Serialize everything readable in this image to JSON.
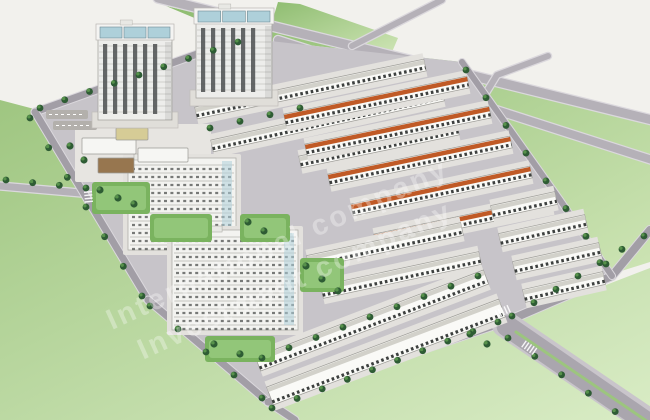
{
  "description": "Aerial 3D architectural rendering of a residential masterplan: two high-rise towers, mid-rise apartment blocks, rows of townhouses (some with orange roofs), tree-lined roads, boulevard with green median, surrounded by light-green fields, with a diagonal white watermark.",
  "watermark": {
    "lines": [
      "International company",
      "Investment company"
    ],
    "color": "#ffffff",
    "opacity": 0.32,
    "font_size": 29,
    "letter_spacing": 3,
    "angle_deg": -24.5,
    "origin": [
      112,
      330
    ],
    "line2_offset": [
      16,
      40
    ]
  },
  "scene": {
    "w": 650,
    "h": 420,
    "colors": {
      "bg": "#f2f1ed",
      "fieldDark": "#8fbd71",
      "fieldLight": "#cde4b4",
      "fieldDark2": "#9fc681",
      "fieldLight2": "#d9ecc5",
      "roadFill": "#b5b1b8",
      "roadCase": "#dbd8dd",
      "roadDark": "#a29ea6",
      "parcel": "#c7c4c9",
      "pad": "#e3e1dd",
      "rowWhite": "#fafaf7",
      "rowRoofWhite": "#d2d1ca",
      "rowWindow": "#3d403f",
      "rowOutline": "#9c9b96",
      "roofOrange": "#c05a26",
      "towerBody": "#ededeb",
      "towerStripe": "#4b4e50",
      "towerGlass": "#aed0da",
      "towerTrim": "#b9b7b2",
      "towerBase": "#e0ded9",
      "midBody": "#f3f3f0",
      "midLine": "#a8a8a2",
      "green1": "#7ab35f",
      "green2": "#98cb7f",
      "treeDark": "#2e5c34",
      "treeLight": "#57924b",
      "clubRoof": "#97764f",
      "court": "#d6cc96",
      "median": "#9cc57e",
      "white": "#ffffff"
    },
    "fields": [
      {
        "name": "field-left-bottom",
        "grad": "gLB",
        "pts": "0,100 38,110 152,302 484,332 650,268 650,420 0,420"
      },
      {
        "name": "field-top-right",
        "grad": "gTR",
        "pts": "166,6 650,118 650,262 612,274 462,62 242,38"
      },
      {
        "name": "field-top-wedge",
        "grad": "gTR",
        "pts": "272,22 392,52 398,38 300,4 278,2"
      }
    ],
    "roads": [
      {
        "name": "arterial-1",
        "w": 9,
        "pts": [
          [
            158,
            -2
          ],
          [
            652,
            120
          ]
        ]
      },
      {
        "name": "arterial-2",
        "w": 8,
        "pts": [
          [
            278,
            40
          ],
          [
            652,
            160
          ]
        ]
      },
      {
        "name": "road-stub-1",
        "w": 6,
        "pts": [
          [
            352,
            46
          ],
          [
            442,
            0
          ]
        ]
      },
      {
        "name": "road-stub-2",
        "w": 6,
        "pts": [
          [
            478,
            106
          ],
          [
            497,
            75
          ],
          [
            548,
            56
          ]
        ]
      },
      {
        "name": "road-stub-left",
        "w": 7,
        "pts": [
          [
            0,
            186
          ],
          [
            92,
            194
          ]
        ]
      }
    ],
    "parcel": "35,112 242,38 462,62 612,276 505,322 268,402 148,300",
    "perimRoads": [
      {
        "name": "perimeter-nw",
        "w": 7,
        "pts": [
          [
            35,
            112
          ],
          [
            242,
            38
          ]
        ]
      },
      {
        "name": "perimeter-west",
        "w": 7,
        "pts": [
          [
            35,
            112
          ],
          [
            148,
            300
          ]
        ]
      },
      {
        "name": "perimeter-sw",
        "w": 7,
        "pts": [
          [
            148,
            300
          ],
          [
            268,
            402
          ]
        ]
      },
      {
        "name": "perimeter-exit-bottom",
        "w": 7,
        "pts": [
          [
            268,
            402
          ],
          [
            295,
            420
          ]
        ]
      },
      {
        "name": "perimeter-south",
        "w": 7,
        "pts": [
          [
            268,
            402
          ],
          [
            505,
            322
          ]
        ]
      },
      {
        "name": "perimeter-se",
        "w": 8,
        "pts": [
          [
            505,
            322
          ],
          [
            612,
            276
          ],
          [
            650,
            230
          ]
        ]
      },
      {
        "name": "perimeter-ne",
        "w": 6,
        "pts": [
          [
            462,
            62
          ],
          [
            560,
            200
          ],
          [
            612,
            276
          ]
        ]
      }
    ],
    "boulevard": {
      "case": {
        "w": 27,
        "pts": [
          [
            505,
            324
          ],
          [
            658,
            428
          ]
        ]
      },
      "lanes": {
        "w": 21,
        "pts": [
          [
            507,
            326
          ],
          [
            658,
            430
          ]
        ]
      },
      "median": {
        "w": 3,
        "pts": [
          [
            516,
            332
          ],
          [
            654,
            426
          ]
        ]
      }
    },
    "zones": [
      {
        "name": "school-grounds",
        "x": 75,
        "y": 124,
        "w": 136,
        "h": 58,
        "fill": "#e7e5e1"
      },
      {
        "name": "parking-strip",
        "x": 46,
        "y": 110,
        "w": 42,
        "h": 9,
        "fill": "#b3b0ac"
      },
      {
        "name": "parking-strip",
        "x": 53,
        "y": 121,
        "w": 44,
        "h": 9,
        "fill": "#b3b0ac"
      }
    ],
    "rows": [
      {
        "roof": "w",
        "x1": 196,
        "y1": 113,
        "x2": 425,
        "y2": 65,
        "w": 12
      },
      {
        "roof": "w",
        "x1": 212,
        "y1": 146,
        "x2": 443,
        "y2": 95,
        "w": 12
      },
      {
        "roof": "w",
        "x1": 300,
        "y1": 162,
        "x2": 458,
        "y2": 129,
        "w": 12
      },
      {
        "roof": "o",
        "x1": 285,
        "y1": 120,
        "x2": 468,
        "y2": 82,
        "w": 12
      },
      {
        "roof": "o",
        "x1": 306,
        "y1": 150,
        "x2": 490,
        "y2": 112,
        "w": 12
      },
      {
        "roof": "o",
        "x1": 329,
        "y1": 180,
        "x2": 511,
        "y2": 142,
        "w": 12
      },
      {
        "roof": "o",
        "x1": 352,
        "y1": 210,
        "x2": 531,
        "y2": 172,
        "w": 12
      },
      {
        "roof": "o",
        "x1": 375,
        "y1": 240,
        "x2": 552,
        "y2": 203,
        "w": 12
      },
      {
        "roof": "w",
        "x1": 308,
        "y1": 262,
        "x2": 462,
        "y2": 229,
        "w": 13
      },
      {
        "roof": "w",
        "x1": 322,
        "y1": 292,
        "x2": 480,
        "y2": 258,
        "w": 13
      },
      {
        "roof": "w",
        "x1": 492,
        "y1": 212,
        "x2": 556,
        "y2": 198,
        "w": 13
      },
      {
        "roof": "w",
        "x1": 500,
        "y1": 240,
        "x2": 586,
        "y2": 221,
        "w": 13
      },
      {
        "roof": "w",
        "x1": 514,
        "y1": 268,
        "x2": 600,
        "y2": 249,
        "w": 13
      },
      {
        "roof": "w",
        "x1": 524,
        "y1": 296,
        "x2": 604,
        "y2": 278,
        "w": 13
      },
      {
        "roof": "w",
        "x1": 258,
        "y1": 364,
        "x2": 486,
        "y2": 277,
        "w": 15
      },
      {
        "roof": "w",
        "x1": 270,
        "y1": 396,
        "x2": 502,
        "y2": 308,
        "w": 19
      }
    ],
    "midrises": [
      {
        "name": "midrise-block-1",
        "x": 128,
        "y": 158,
        "w": 108,
        "h": 92
      },
      {
        "name": "midrise-block-2",
        "x": 172,
        "y": 230,
        "w": 126,
        "h": 100
      }
    ],
    "courtyards": [
      {
        "x": 92,
        "y": 182,
        "w": 58,
        "h": 32
      },
      {
        "x": 150,
        "y": 214,
        "w": 62,
        "h": 28
      },
      {
        "x": 240,
        "y": 214,
        "w": 50,
        "h": 28
      },
      {
        "x": 300,
        "y": 258,
        "w": 44,
        "h": 34
      },
      {
        "x": 205,
        "y": 336,
        "w": 70,
        "h": 26
      }
    ],
    "schoolBuildings": [
      {
        "name": "school-building",
        "x": 82,
        "y": 138,
        "w": 54,
        "h": 16,
        "fill": "#f6f6f3"
      },
      {
        "name": "school-building",
        "x": 138,
        "y": 148,
        "w": 50,
        "h": 14,
        "fill": "#f6f6f3"
      },
      {
        "name": "clubhouse-roof",
        "x": 98,
        "y": 158,
        "w": 36,
        "h": 15,
        "fill": "#97764f"
      },
      {
        "name": "sports-court",
        "x": 116,
        "y": 128,
        "w": 32,
        "h": 12,
        "fill": "#d6cc96"
      }
    ],
    "towers": [
      {
        "name": "tower-1",
        "x": 98,
        "y": 26,
        "w": 74,
        "h": 94
      },
      {
        "name": "tower-2",
        "x": 196,
        "y": 10,
        "w": 76,
        "h": 88
      }
    ],
    "treelines": [
      {
        "x1": 40,
        "y1": 108,
        "x2": 238,
        "y2": 42,
        "n": 9
      },
      {
        "x1": 30,
        "y1": 118,
        "x2": 142,
        "y2": 296,
        "n": 7
      },
      {
        "x1": 150,
        "y1": 306,
        "x2": 262,
        "y2": 398,
        "n": 5
      },
      {
        "x1": 272,
        "y1": 408,
        "x2": 498,
        "y2": 322,
        "n": 10
      },
      {
        "x1": 512,
        "y1": 316,
        "x2": 644,
        "y2": 236,
        "n": 7
      },
      {
        "x1": 466,
        "y1": 70,
        "x2": 606,
        "y2": 264,
        "n": 8
      },
      {
        "x1": 508,
        "y1": 338,
        "x2": 642,
        "y2": 430,
        "n": 6
      },
      {
        "x1": 6,
        "y1": 180,
        "x2": 86,
        "y2": 188,
        "n": 4
      },
      {
        "x1": 262,
        "y1": 358,
        "x2": 478,
        "y2": 276,
        "n": 9
      },
      {
        "x1": 210,
        "y1": 128,
        "x2": 300,
        "y2": 108,
        "n": 4
      }
    ],
    "trees": [
      {
        "x": 100,
        "y": 190
      },
      {
        "x": 118,
        "y": 198
      },
      {
        "x": 134,
        "y": 204
      },
      {
        "x": 248,
        "y": 222
      },
      {
        "x": 264,
        "y": 231
      },
      {
        "x": 306,
        "y": 266
      },
      {
        "x": 322,
        "y": 279
      },
      {
        "x": 338,
        "y": 291
      },
      {
        "x": 214,
        "y": 344
      },
      {
        "x": 240,
        "y": 354
      },
      {
        "x": 470,
        "y": 334
      },
      {
        "x": 487,
        "y": 344
      },
      {
        "x": 84,
        "y": 160
      },
      {
        "x": 70,
        "y": 146
      }
    ],
    "crosswalks": [
      {
        "x": 497,
        "y": 314,
        "ux": 0.91,
        "uy": -0.41,
        "n": 5
      },
      {
        "x": 524,
        "y": 344,
        "ux": 0.82,
        "uy": 0.57,
        "n": 5
      },
      {
        "x": 88,
        "y": 192,
        "ux": 0.1,
        "uy": 1,
        "n": 4
      }
    ]
  }
}
